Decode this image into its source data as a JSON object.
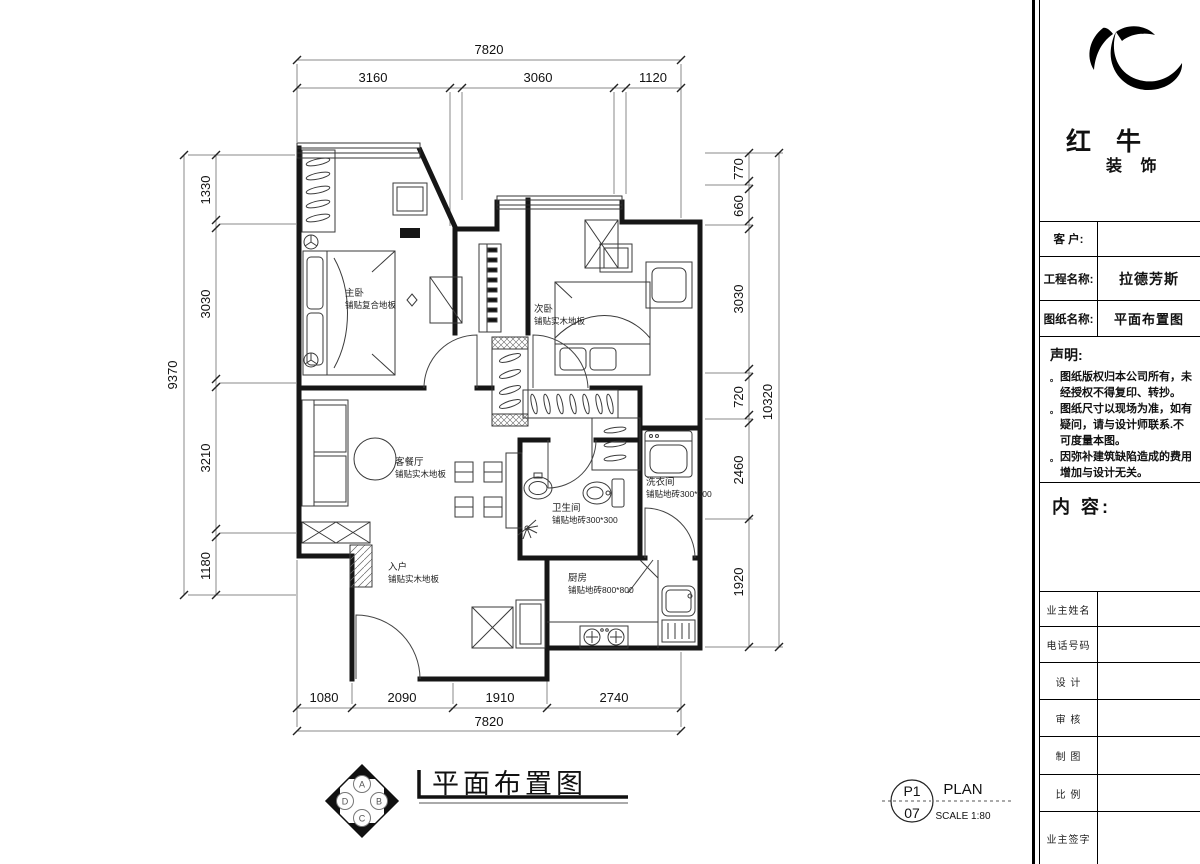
{
  "sidebar": {
    "brand": {
      "title": "红 牛",
      "subtitle": "装 饰"
    },
    "fields": [
      {
        "label": "客  户:",
        "value": ""
      },
      {
        "label": "工程名称:",
        "value": "拉德芳斯"
      },
      {
        "label": "图纸名称:",
        "value": "平面布置图"
      }
    ],
    "statement": {
      "title": "声明:",
      "bullet": "。",
      "items": [
        "图纸版权归本公司所有，未经授权不得复印、转抄。",
        "图纸尺寸以现场为准，如有疑问，请与设计师联系.不可度量本图。",
        "因弥补建筑缺陷造成的费用增加与设计无关。"
      ]
    },
    "content_label": "内 容:",
    "rows": [
      {
        "label": "业主姓名"
      },
      {
        "label": "电话号码"
      },
      {
        "label": "设 计"
      },
      {
        "label": "审 核"
      },
      {
        "label": "制 图"
      },
      {
        "label": "比 例"
      },
      {
        "label": "业主签字"
      }
    ]
  },
  "plan": {
    "rooms": {
      "master": {
        "name": "主卧",
        "floor": "铺贴复合地板"
      },
      "second": {
        "name": "次卧",
        "floor": "铺贴实木地板"
      },
      "living": {
        "name": "客餐厅",
        "floor": "铺贴实木地板"
      },
      "entry": {
        "name": "入户",
        "floor": "铺贴实木地板"
      },
      "bath": {
        "name": "卫生间",
        "floor": "铺贴地砖300*300"
      },
      "laundry": {
        "name": "洗衣间",
        "floor": "铺贴地砖300*300"
      },
      "kitchen": {
        "name": "厨房",
        "floor": "铺贴地砖800*800"
      }
    },
    "dims": {
      "top_total": "7820",
      "top_segments": [
        "3160",
        "3060",
        "1120"
      ],
      "bottom_segments": [
        "1080",
        "2090",
        "1910",
        "2740"
      ],
      "bottom_total": "7820",
      "left_total": "9370",
      "left_segments": [
        "1330",
        "3030",
        "3210",
        "1180"
      ],
      "right_total": "10320",
      "right_segments": [
        "770",
        "660",
        "3030",
        "720",
        "2460",
        "1920"
      ]
    }
  },
  "footer": {
    "title": "平面布置图",
    "compass": {
      "a": "A",
      "b": "B",
      "c": "C",
      "d": "D"
    },
    "page": {
      "code": "P1",
      "sheet": "07",
      "label": "PLAN",
      "scale": "SCALE 1:80"
    }
  }
}
